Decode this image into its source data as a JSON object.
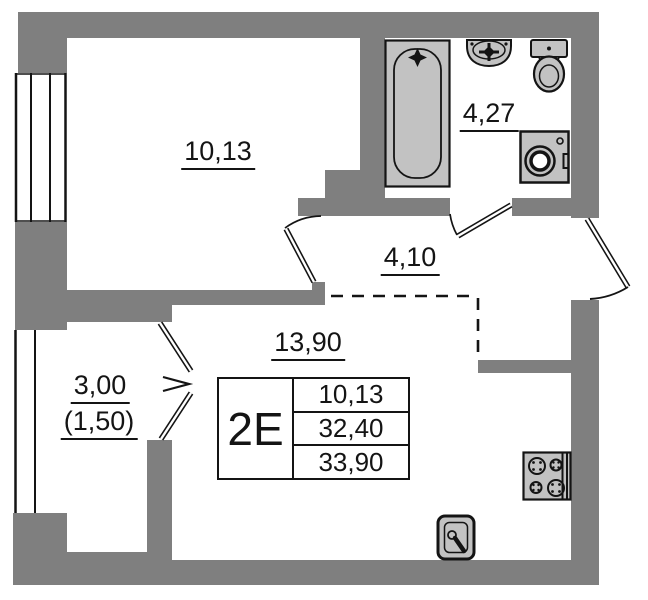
{
  "unit": {
    "type": "2E",
    "legend_rows": [
      "10,13",
      "32,40",
      "33,90"
    ]
  },
  "rooms": {
    "bedroom": {
      "area": "10,13"
    },
    "bathroom": {
      "area": "4,27"
    },
    "hallway": {
      "area": "4,10"
    },
    "living_kitchen": {
      "area": "13,90"
    },
    "balcony": {
      "area": "3,00",
      "area_with_coefficient": "(1,50)"
    }
  },
  "colors": {
    "wall": "#7f7f7f",
    "fixture_fill": "#c2c2c2",
    "outline": "#141414",
    "floor": "#ffffff"
  },
  "icons": {
    "bathtub-icon": "svg-outline-shape",
    "bathroom-sink-icon": "svg-outline-shape",
    "toilet-icon": "svg-outline-shape",
    "washing-machine-icon": "svg-outline-shape",
    "stove-icon": "svg-outline-shape",
    "kitchen-sink-icon": "svg-outline-shape",
    "window-icon": "parallel-lines",
    "door-icon": "leaf-with-swing-arc"
  }
}
